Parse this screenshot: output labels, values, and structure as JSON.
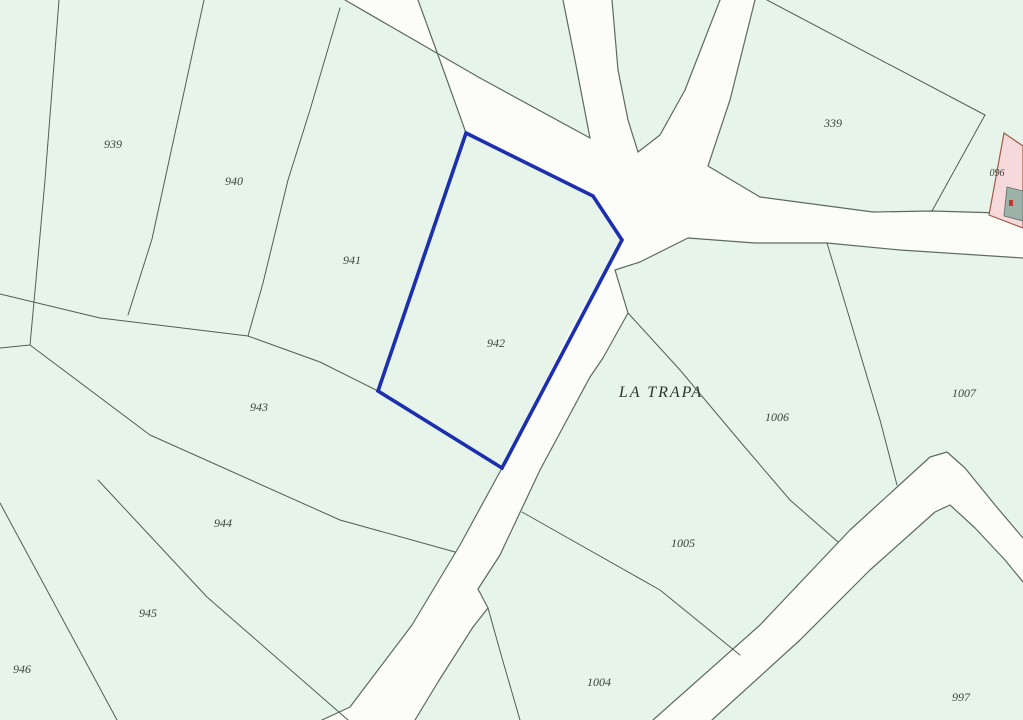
{
  "map": {
    "type": "cadastral-parcel-map",
    "place_label": "LA TRAPA",
    "highlighted_parcel": "942",
    "parcels": [
      {
        "id": "939"
      },
      {
        "id": "940"
      },
      {
        "id": "941"
      },
      {
        "id": "942"
      },
      {
        "id": "943"
      },
      {
        "id": "944"
      },
      {
        "id": "945"
      },
      {
        "id": "946"
      },
      {
        "id": "339"
      },
      {
        "id": "096"
      },
      {
        "id": "1007"
      },
      {
        "id": "1006"
      },
      {
        "id": "1005"
      },
      {
        "id": "1004"
      },
      {
        "id": "997"
      }
    ],
    "colors": {
      "land": "#e7f4e9",
      "road": "#fcfcf8",
      "boundary": "#4f5f55",
      "highlight": "#1c2fae",
      "urban_parcel": "#f6d9da",
      "building": "#9db3a9",
      "building_mark": "#c03a2b"
    }
  }
}
